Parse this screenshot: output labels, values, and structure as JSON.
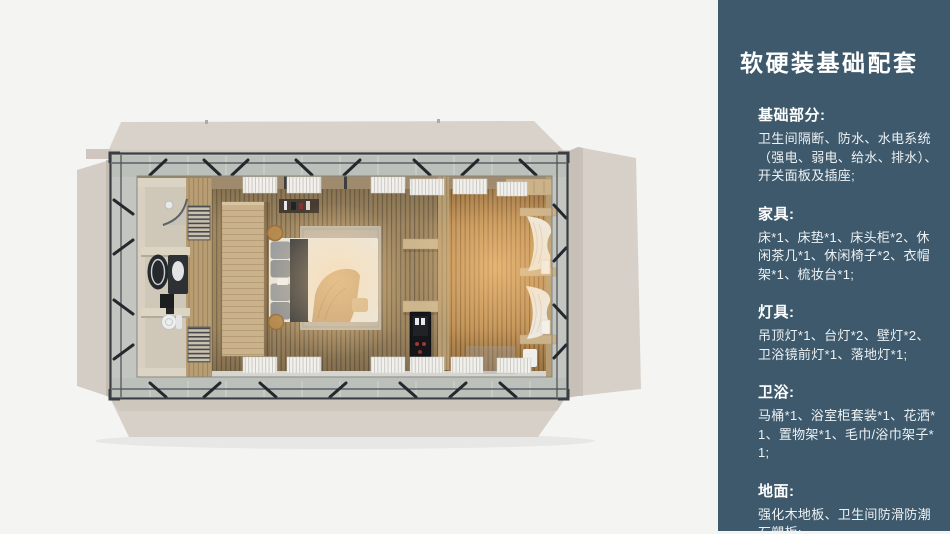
{
  "sidebar": {
    "background": "#3d596b",
    "text_color": "#ffffff",
    "title": "软硬装基础配套",
    "sections": [
      {
        "heading": "基础部分:",
        "body": "卫生间隔断、防水、水电系统（强电、弱电、给水、排水）、开关面板及插座;"
      },
      {
        "heading": "家具:",
        "body": "床*1、床垫*1、床头柜*2、休闲茶几*1、休闲椅子*2、衣帽架*1、梳妆台*1;"
      },
      {
        "heading": "灯具:",
        "body": "吊顶灯*1、台灯*2、壁灯*2、卫浴镜前灯*1、落地灯*1;"
      },
      {
        "heading": "卫浴:",
        "body": "马桶*1、浴室柜套装*1、花洒*1、置物架*1、毛巾/浴巾架子*1;"
      },
      {
        "heading": "地面:",
        "body": "强化木地板、卫生间防滑防潮石塑板;"
      }
    ]
  },
  "floorplan": {
    "view": "top-down 3d room module render",
    "palette": {
      "page_background": "#f4f4f2",
      "folded_panels": "#d8d1c9",
      "steel_frame": "#3a3e44",
      "deck_band": "#c2c5c0",
      "bedroom_floor": "#a08760",
      "warm_floor": "#be8f55",
      "bathroom_walls": "#cfc7b7",
      "bed_duvet": "#ece8df",
      "glow": "#ffd79a"
    }
  }
}
